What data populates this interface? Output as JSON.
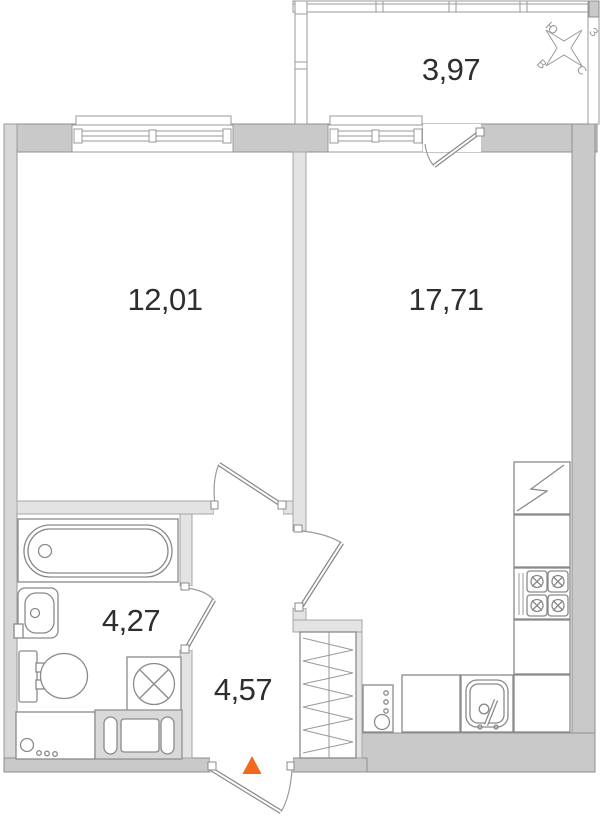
{
  "rooms": [
    {
      "id": "balcony",
      "area": "3,97"
    },
    {
      "id": "living-room",
      "area": "12,01"
    },
    {
      "id": "kitchen-living",
      "area": "17,71"
    },
    {
      "id": "bathroom",
      "area": "4,27"
    },
    {
      "id": "hallway",
      "area": "4,57"
    }
  ],
  "compass": {
    "north": "С",
    "south": "Ю",
    "west": "З",
    "east": "В"
  },
  "colors": {
    "exterior_wall": "#c9c9c9",
    "interior_wall": "#e3e3e3",
    "party_wall": "#d8d8d8",
    "wall_outline": "#8e8e8e",
    "fixture_stroke": "#8a8a8a",
    "label_text": "#2e2e2e",
    "entry_arrow": "#f2691d",
    "compass_stroke": "#9a9a9a"
  }
}
